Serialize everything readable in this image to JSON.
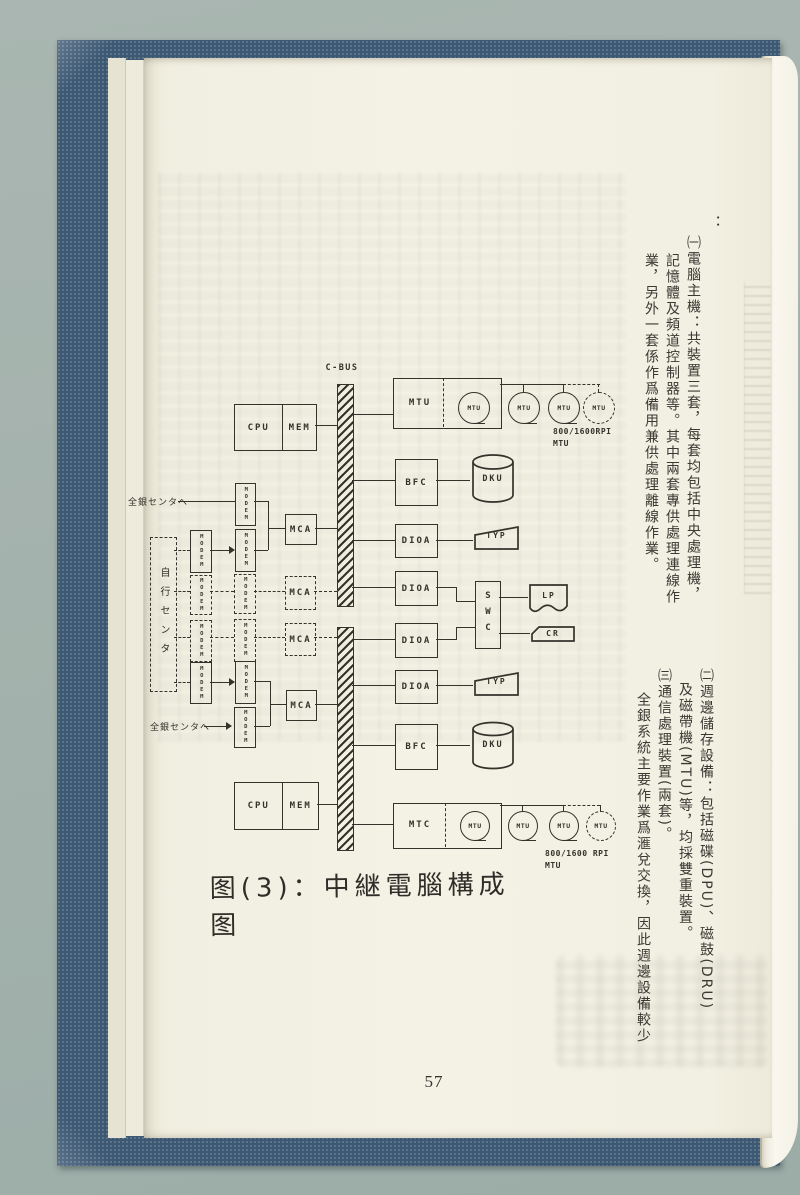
{
  "page": {
    "number": "57",
    "caption": "图(3)：中継電腦構成图"
  },
  "text": {
    "top_lead": "：",
    "top": [
      "㈠電腦主機：共裝置三套，每套均包括中央處理機，",
      "記憶體及頻道控制器等。其中兩套專供處理連線作",
      "業，另外一套係作爲備用兼供處理離線作業。"
    ],
    "bottom": [
      "㈡週邊儲存設備：包括磁碟(DPU)、磁鼓(DRU)",
      "及磁帶機(MTU)等，均採雙重裝置。",
      "㈢通信處理裝置(兩套)。",
      "全銀系統主要作業爲滙兌交換，因此週邊設備較少"
    ]
  },
  "diagram": {
    "cbus": "C-BUS",
    "cpu": "CPU",
    "mem": "MEM",
    "mtu": "MTU",
    "mtc": "MTC",
    "bfc": "BFC",
    "dku": "DKU",
    "dioa": "DIOA",
    "typ": "TYP",
    "swc": "SWC",
    "lp": "LP",
    "cr": "CR",
    "mca": "MCA",
    "modem": "MODEM",
    "tape_spec_top": "800/1600RPI",
    "tape_spec_top_unit": "MTU",
    "tape_spec_bottom": "800/1600 RPI",
    "tape_spec_bottom_unit": "MTU",
    "own_center": "自行センタ",
    "zengin_center": "全銀センタへ"
  }
}
